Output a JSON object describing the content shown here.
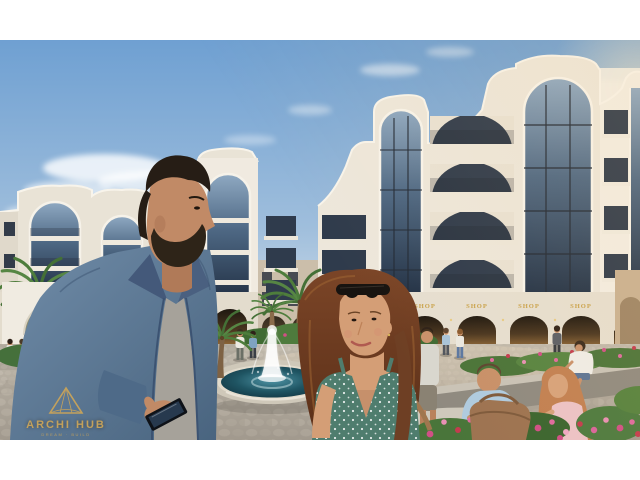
{
  "scene": {
    "description": "Sunlit architectural rendering of a white resort-style apartment complex with curved wavy parapets and tall arched glass bays, ground-floor shop arcade, palm trees, flower beds and a circular plaza fountain; a bearded man in a denim jacket holding a phone and a woman in a green polka-dot dress walk in the foreground while a couple sits with a tablet among pink flowers."
  },
  "shops": {
    "sign_color": "#C9A24B",
    "signs": [
      "SHOP",
      "SHOP",
      "SHOP",
      "SHOP",
      "SHOP"
    ]
  },
  "watermark": {
    "brand": "ARCHI HUB",
    "tagline": "DREAM · BUILD",
    "color": "#C9A45A"
  },
  "palette": {
    "sky_top": "#6FA0D2",
    "sky_horizon": "#DCE5EC",
    "building_cream": "#EDE7DB",
    "window_glass": "#33425A",
    "fountain_water": "#1E4A58",
    "pavement": "#AFA79C",
    "foliage_green": "#4C7A3F",
    "flower_pink": "#D9649C",
    "accent_gold": "#C9A45A"
  }
}
